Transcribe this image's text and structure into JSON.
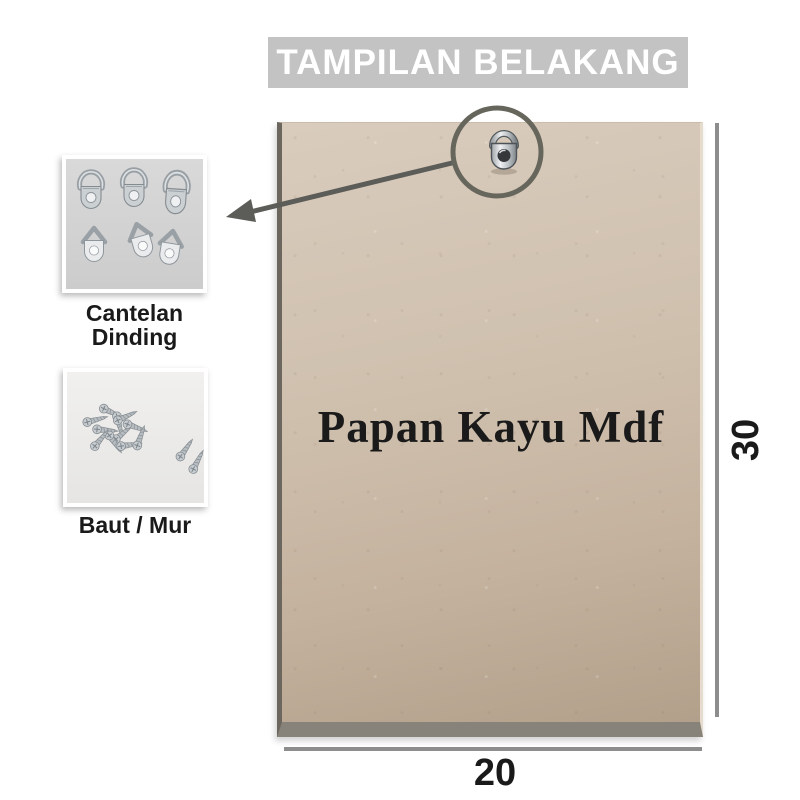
{
  "banner": {
    "title": "TAMPILAN BELAKANG"
  },
  "board": {
    "label": "Papan Kayu Mdf"
  },
  "dimensions": {
    "height": "30",
    "width": "20"
  },
  "callouts": {
    "hangers": {
      "caption_line1": "Cantelan",
      "caption_line2": "Dinding",
      "icon": "d-ring-hanger-icon"
    },
    "screws": {
      "caption": "Baut / Mur",
      "icon": "screws-pile-icon"
    }
  },
  "annotations": {
    "hook_icon": "d-ring-hook-icon",
    "highlight": "circle-with-arrow"
  },
  "colors": {
    "banner_bg": "#c4c3c3",
    "banner_text": "#ffffff",
    "board_tan": "#cfc0ae",
    "annotation_gray": "#5c5c58",
    "dimension_line_gray": "#8d8d8d",
    "label_black": "#1a1a1a"
  }
}
